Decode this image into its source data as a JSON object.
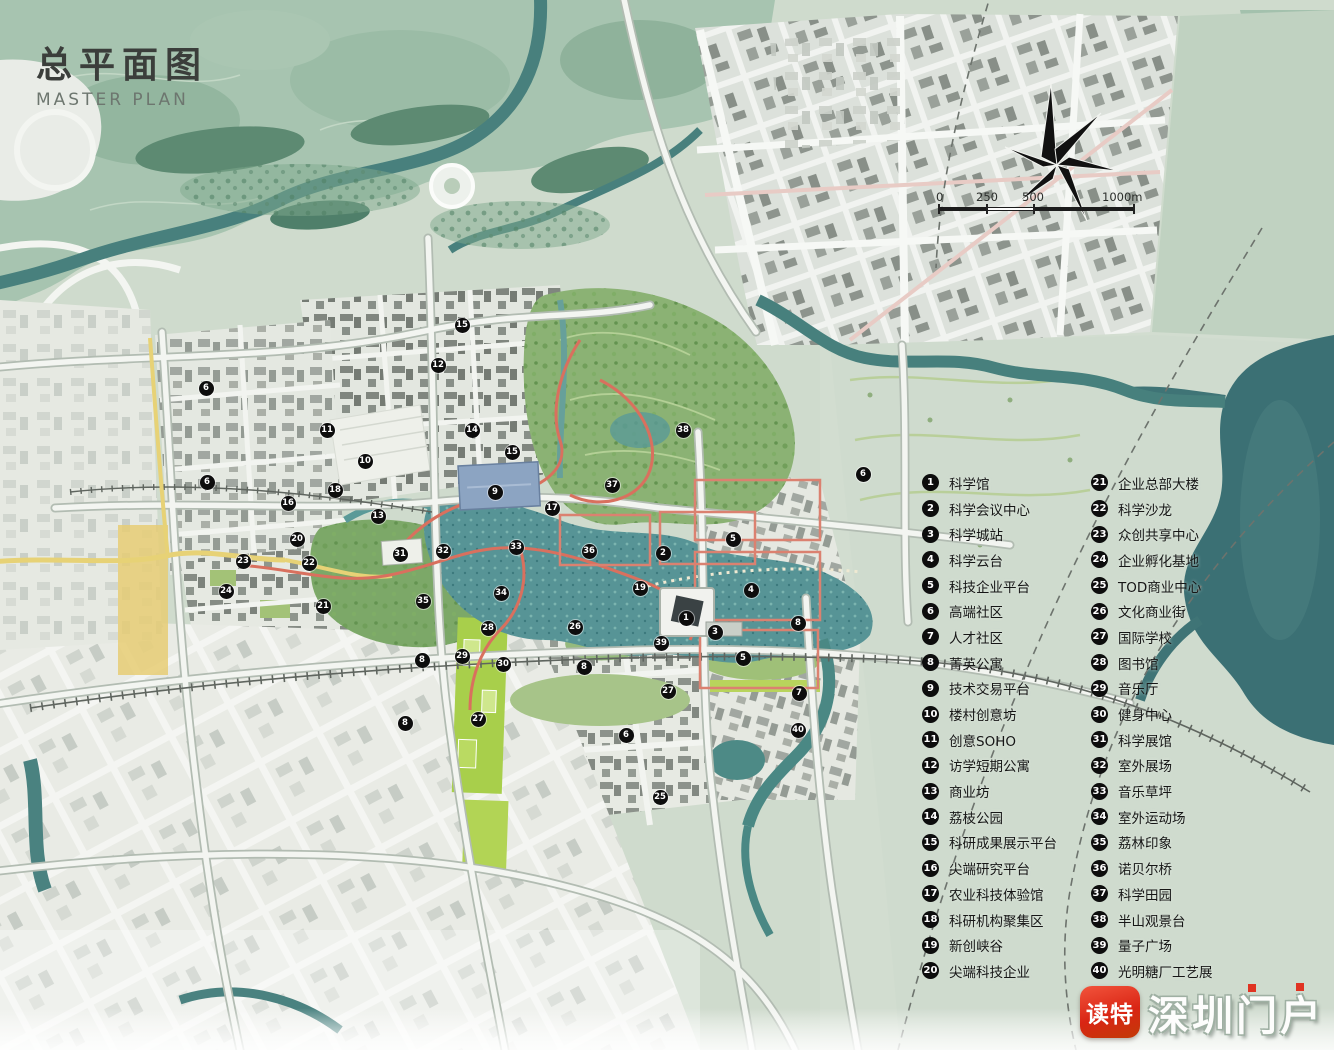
{
  "title": {
    "zh": "总平面图",
    "en": "MASTER PLAN"
  },
  "scale_bar": {
    "labels": [
      "0",
      "250",
      "500",
      "1000m"
    ]
  },
  "legend": {
    "column1": [
      {
        "num": "1",
        "label": "科学馆"
      },
      {
        "num": "2",
        "label": "科学会议中心"
      },
      {
        "num": "3",
        "label": "科学城站"
      },
      {
        "num": "4",
        "label": "科学云台"
      },
      {
        "num": "5",
        "label": "科技企业平台"
      },
      {
        "num": "6",
        "label": "高端社区"
      },
      {
        "num": "7",
        "label": "人才社区"
      },
      {
        "num": "8",
        "label": "菁英公寓"
      },
      {
        "num": "9",
        "label": "技术交易平台"
      },
      {
        "num": "10",
        "label": "楼村创意坊"
      },
      {
        "num": "11",
        "label": "创意SOHO"
      },
      {
        "num": "12",
        "label": "访学短期公寓"
      },
      {
        "num": "13",
        "label": "商业坊"
      },
      {
        "num": "14",
        "label": "荔枝公园"
      },
      {
        "num": "15",
        "label": "科研成果展示平台"
      },
      {
        "num": "16",
        "label": "尖端研究平台"
      },
      {
        "num": "17",
        "label": "农业科技体验馆"
      },
      {
        "num": "18",
        "label": "科研机构聚集区"
      },
      {
        "num": "19",
        "label": "新创峡谷"
      },
      {
        "num": "20",
        "label": "尖端科技企业"
      }
    ],
    "column2": [
      {
        "num": "21",
        "label": "企业总部大楼"
      },
      {
        "num": "22",
        "label": "科学沙龙"
      },
      {
        "num": "23",
        "label": "众创共享中心"
      },
      {
        "num": "24",
        "label": "企业孵化基地"
      },
      {
        "num": "25",
        "label": "TOD商业中心"
      },
      {
        "num": "26",
        "label": "文化商业街"
      },
      {
        "num": "27",
        "label": "国际学校"
      },
      {
        "num": "28",
        "label": "图书馆"
      },
      {
        "num": "29",
        "label": "音乐厅"
      },
      {
        "num": "30",
        "label": "健身中心"
      },
      {
        "num": "31",
        "label": "科学展馆"
      },
      {
        "num": "32",
        "label": "室外展场"
      },
      {
        "num": "33",
        "label": "音乐草坪"
      },
      {
        "num": "34",
        "label": "室外运动场"
      },
      {
        "num": "35",
        "label": "荔林印象"
      },
      {
        "num": "36",
        "label": "诺贝尔桥"
      },
      {
        "num": "37",
        "label": "科学田园"
      },
      {
        "num": "38",
        "label": "半山观景台"
      },
      {
        "num": "39",
        "label": "量子广场"
      },
      {
        "num": "40",
        "label": "光明糖厂工艺展"
      }
    ]
  },
  "map": {
    "markers": [
      {
        "n": "1",
        "x": 686,
        "y": 618
      },
      {
        "n": "2",
        "x": 663,
        "y": 553
      },
      {
        "n": "3",
        "x": 715,
        "y": 632
      },
      {
        "n": "4",
        "x": 751,
        "y": 590
      },
      {
        "n": "5",
        "x": 733,
        "y": 539
      },
      {
        "n": "5",
        "x": 743,
        "y": 658
      },
      {
        "n": "6",
        "x": 206,
        "y": 388
      },
      {
        "n": "6",
        "x": 207,
        "y": 482
      },
      {
        "n": "6",
        "x": 626,
        "y": 735
      },
      {
        "n": "6",
        "x": 863,
        "y": 474
      },
      {
        "n": "7",
        "x": 799,
        "y": 693
      },
      {
        "n": "8",
        "x": 422,
        "y": 660
      },
      {
        "n": "8",
        "x": 584,
        "y": 667
      },
      {
        "n": "8",
        "x": 405,
        "y": 723
      },
      {
        "n": "8",
        "x": 798,
        "y": 623
      },
      {
        "n": "9",
        "x": 495,
        "y": 492
      },
      {
        "n": "10",
        "x": 365,
        "y": 461
      },
      {
        "n": "11",
        "x": 327,
        "y": 430
      },
      {
        "n": "12",
        "x": 438,
        "y": 365
      },
      {
        "n": "13",
        "x": 378,
        "y": 516
      },
      {
        "n": "14",
        "x": 472,
        "y": 430
      },
      {
        "n": "15",
        "x": 462,
        "y": 325
      },
      {
        "n": "15",
        "x": 512,
        "y": 452
      },
      {
        "n": "16",
        "x": 288,
        "y": 503
      },
      {
        "n": "17",
        "x": 552,
        "y": 508
      },
      {
        "n": "18",
        "x": 335,
        "y": 490
      },
      {
        "n": "19",
        "x": 640,
        "y": 588
      },
      {
        "n": "20",
        "x": 297,
        "y": 539
      },
      {
        "n": "21",
        "x": 323,
        "y": 606
      },
      {
        "n": "22",
        "x": 309,
        "y": 563
      },
      {
        "n": "23",
        "x": 243,
        "y": 561
      },
      {
        "n": "24",
        "x": 226,
        "y": 591
      },
      {
        "n": "25",
        "x": 660,
        "y": 797
      },
      {
        "n": "26",
        "x": 575,
        "y": 627
      },
      {
        "n": "27",
        "x": 668,
        "y": 691
      },
      {
        "n": "27",
        "x": 478,
        "y": 719
      },
      {
        "n": "28",
        "x": 488,
        "y": 628
      },
      {
        "n": "29",
        "x": 462,
        "y": 656
      },
      {
        "n": "30",
        "x": 503,
        "y": 664
      },
      {
        "n": "31",
        "x": 400,
        "y": 554
      },
      {
        "n": "32",
        "x": 443,
        "y": 551
      },
      {
        "n": "33",
        "x": 516,
        "y": 547
      },
      {
        "n": "34",
        "x": 501,
        "y": 593
      },
      {
        "n": "35",
        "x": 423,
        "y": 601
      },
      {
        "n": "36",
        "x": 589,
        "y": 551
      },
      {
        "n": "37",
        "x": 612,
        "y": 485
      },
      {
        "n": "38",
        "x": 683,
        "y": 430
      },
      {
        "n": "39",
        "x": 661,
        "y": 643
      },
      {
        "n": "40",
        "x": 798,
        "y": 730
      }
    ]
  },
  "watermark": {
    "badge": "读特",
    "text": "深圳门户"
  },
  "colors": {
    "terrain_hill": "#a7c4b0",
    "terrain_pale": "#cfdbcd",
    "water": "#3b7074",
    "river": "#579496",
    "park": "#8bb274",
    "sports_green": "#a8cf4b",
    "road": "#f3f5f1",
    "path_red": "#d9705e",
    "road_yellow": "#e7d276",
    "marker_black": "#0d0d0d",
    "watermark_red": "#d92514"
  }
}
